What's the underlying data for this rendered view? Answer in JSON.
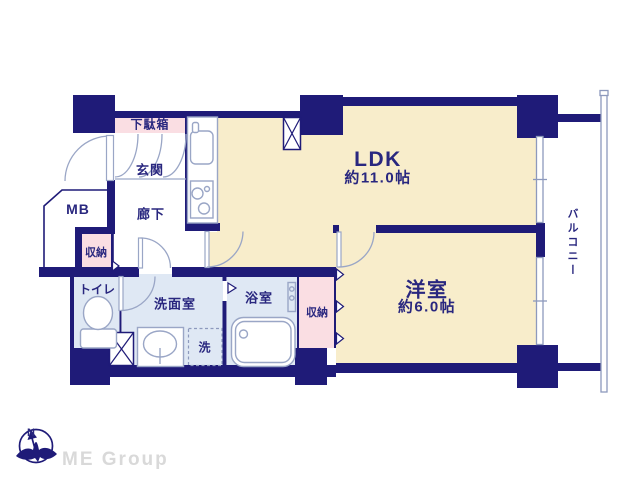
{
  "rooms": {
    "ldk": {
      "label": "LDK",
      "size": "約11.0帖"
    },
    "western": {
      "label": "洋室",
      "size": "約6.0帖"
    },
    "balcony": {
      "label": "バルコニー"
    },
    "entrance": {
      "label": "玄関"
    },
    "hallway": {
      "label": "廊下"
    },
    "shoe_cabinet": {
      "label": "下駄箱"
    },
    "meter_box": {
      "label": "MB"
    },
    "hall_storage": {
      "label": "収納"
    },
    "toilet": {
      "label": "トイレ"
    },
    "washroom": {
      "label": "洗面室"
    },
    "bathroom": {
      "label": "浴室"
    },
    "western_storage": {
      "label": "収納"
    },
    "washer": {
      "label": "洗"
    }
  },
  "compass": {
    "north": "N"
  },
  "brand": {
    "name": "ME Group"
  },
  "colors": {
    "wall": "#1f1b78",
    "cream": "#f8edcb",
    "pink": "#fadee3",
    "blue": "#dfe8f4",
    "line": "#9aa6c6",
    "winline": "#8d99bd",
    "text": "#29277f",
    "brand": "#d9d9d9"
  }
}
